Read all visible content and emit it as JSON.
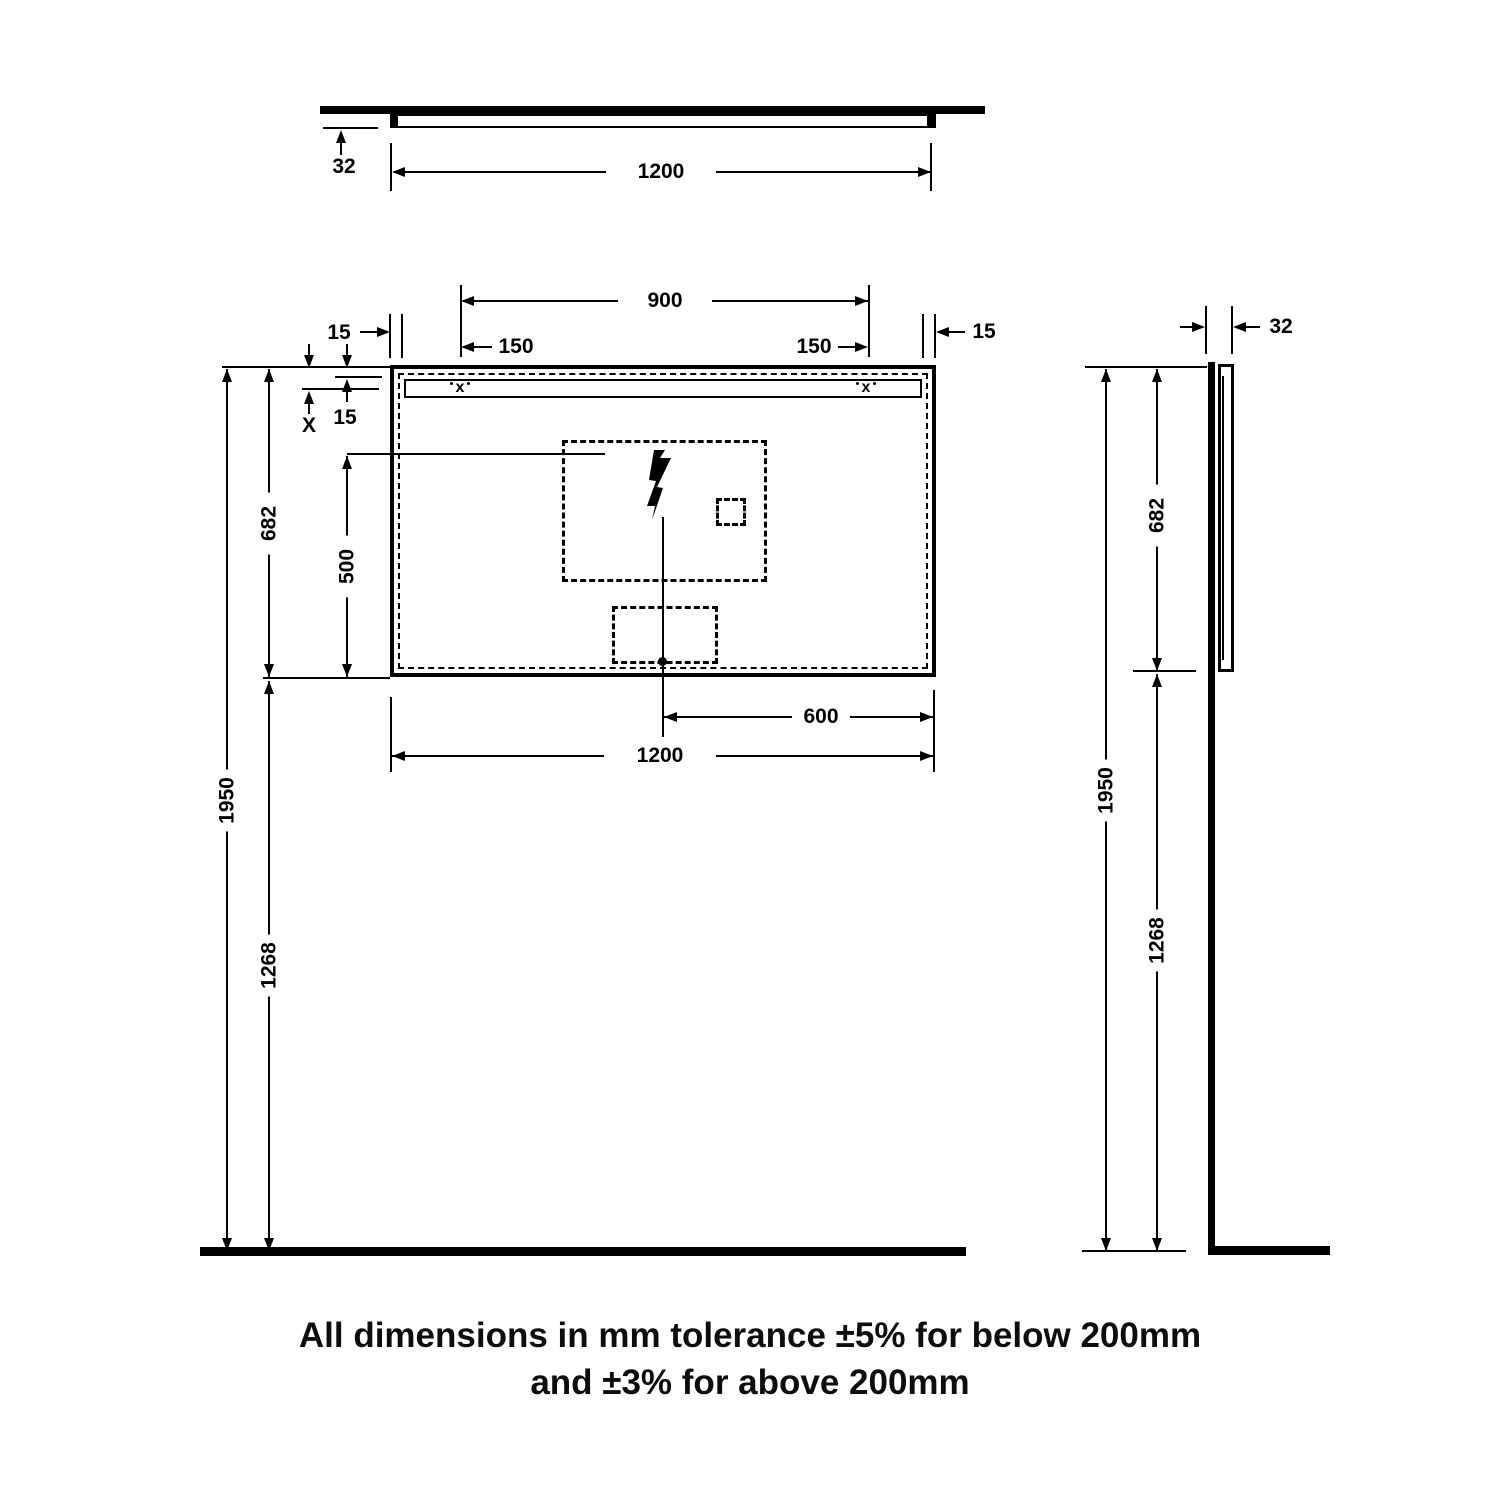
{
  "drawing": {
    "title_context": "mirror-dimension-drawing",
    "colors": {
      "ink": "#000000",
      "paper": "#ffffff"
    },
    "labels": {
      "top_width": "1200",
      "top_depth": "32",
      "front_span": "900",
      "front_inset_left": "150",
      "front_inset_right": "150",
      "front_edge_left": "15",
      "front_edge_right": "15",
      "front_strip_gap": "15",
      "front_x": "X",
      "front_height": "682",
      "front_pad_height": "500",
      "front_center_offset": "600",
      "front_width": "1200",
      "front_total_height": "1950",
      "front_lower_height": "1268",
      "side_depth": "32",
      "side_height": "682",
      "side_total_height": "1950",
      "side_lower_height": "1268"
    },
    "markers": {
      "mount": "x"
    },
    "footer": {
      "line1": "All dimensions in mm tolerance ±5% for below 200mm",
      "line2": "and ±3% for above 200mm"
    }
  }
}
